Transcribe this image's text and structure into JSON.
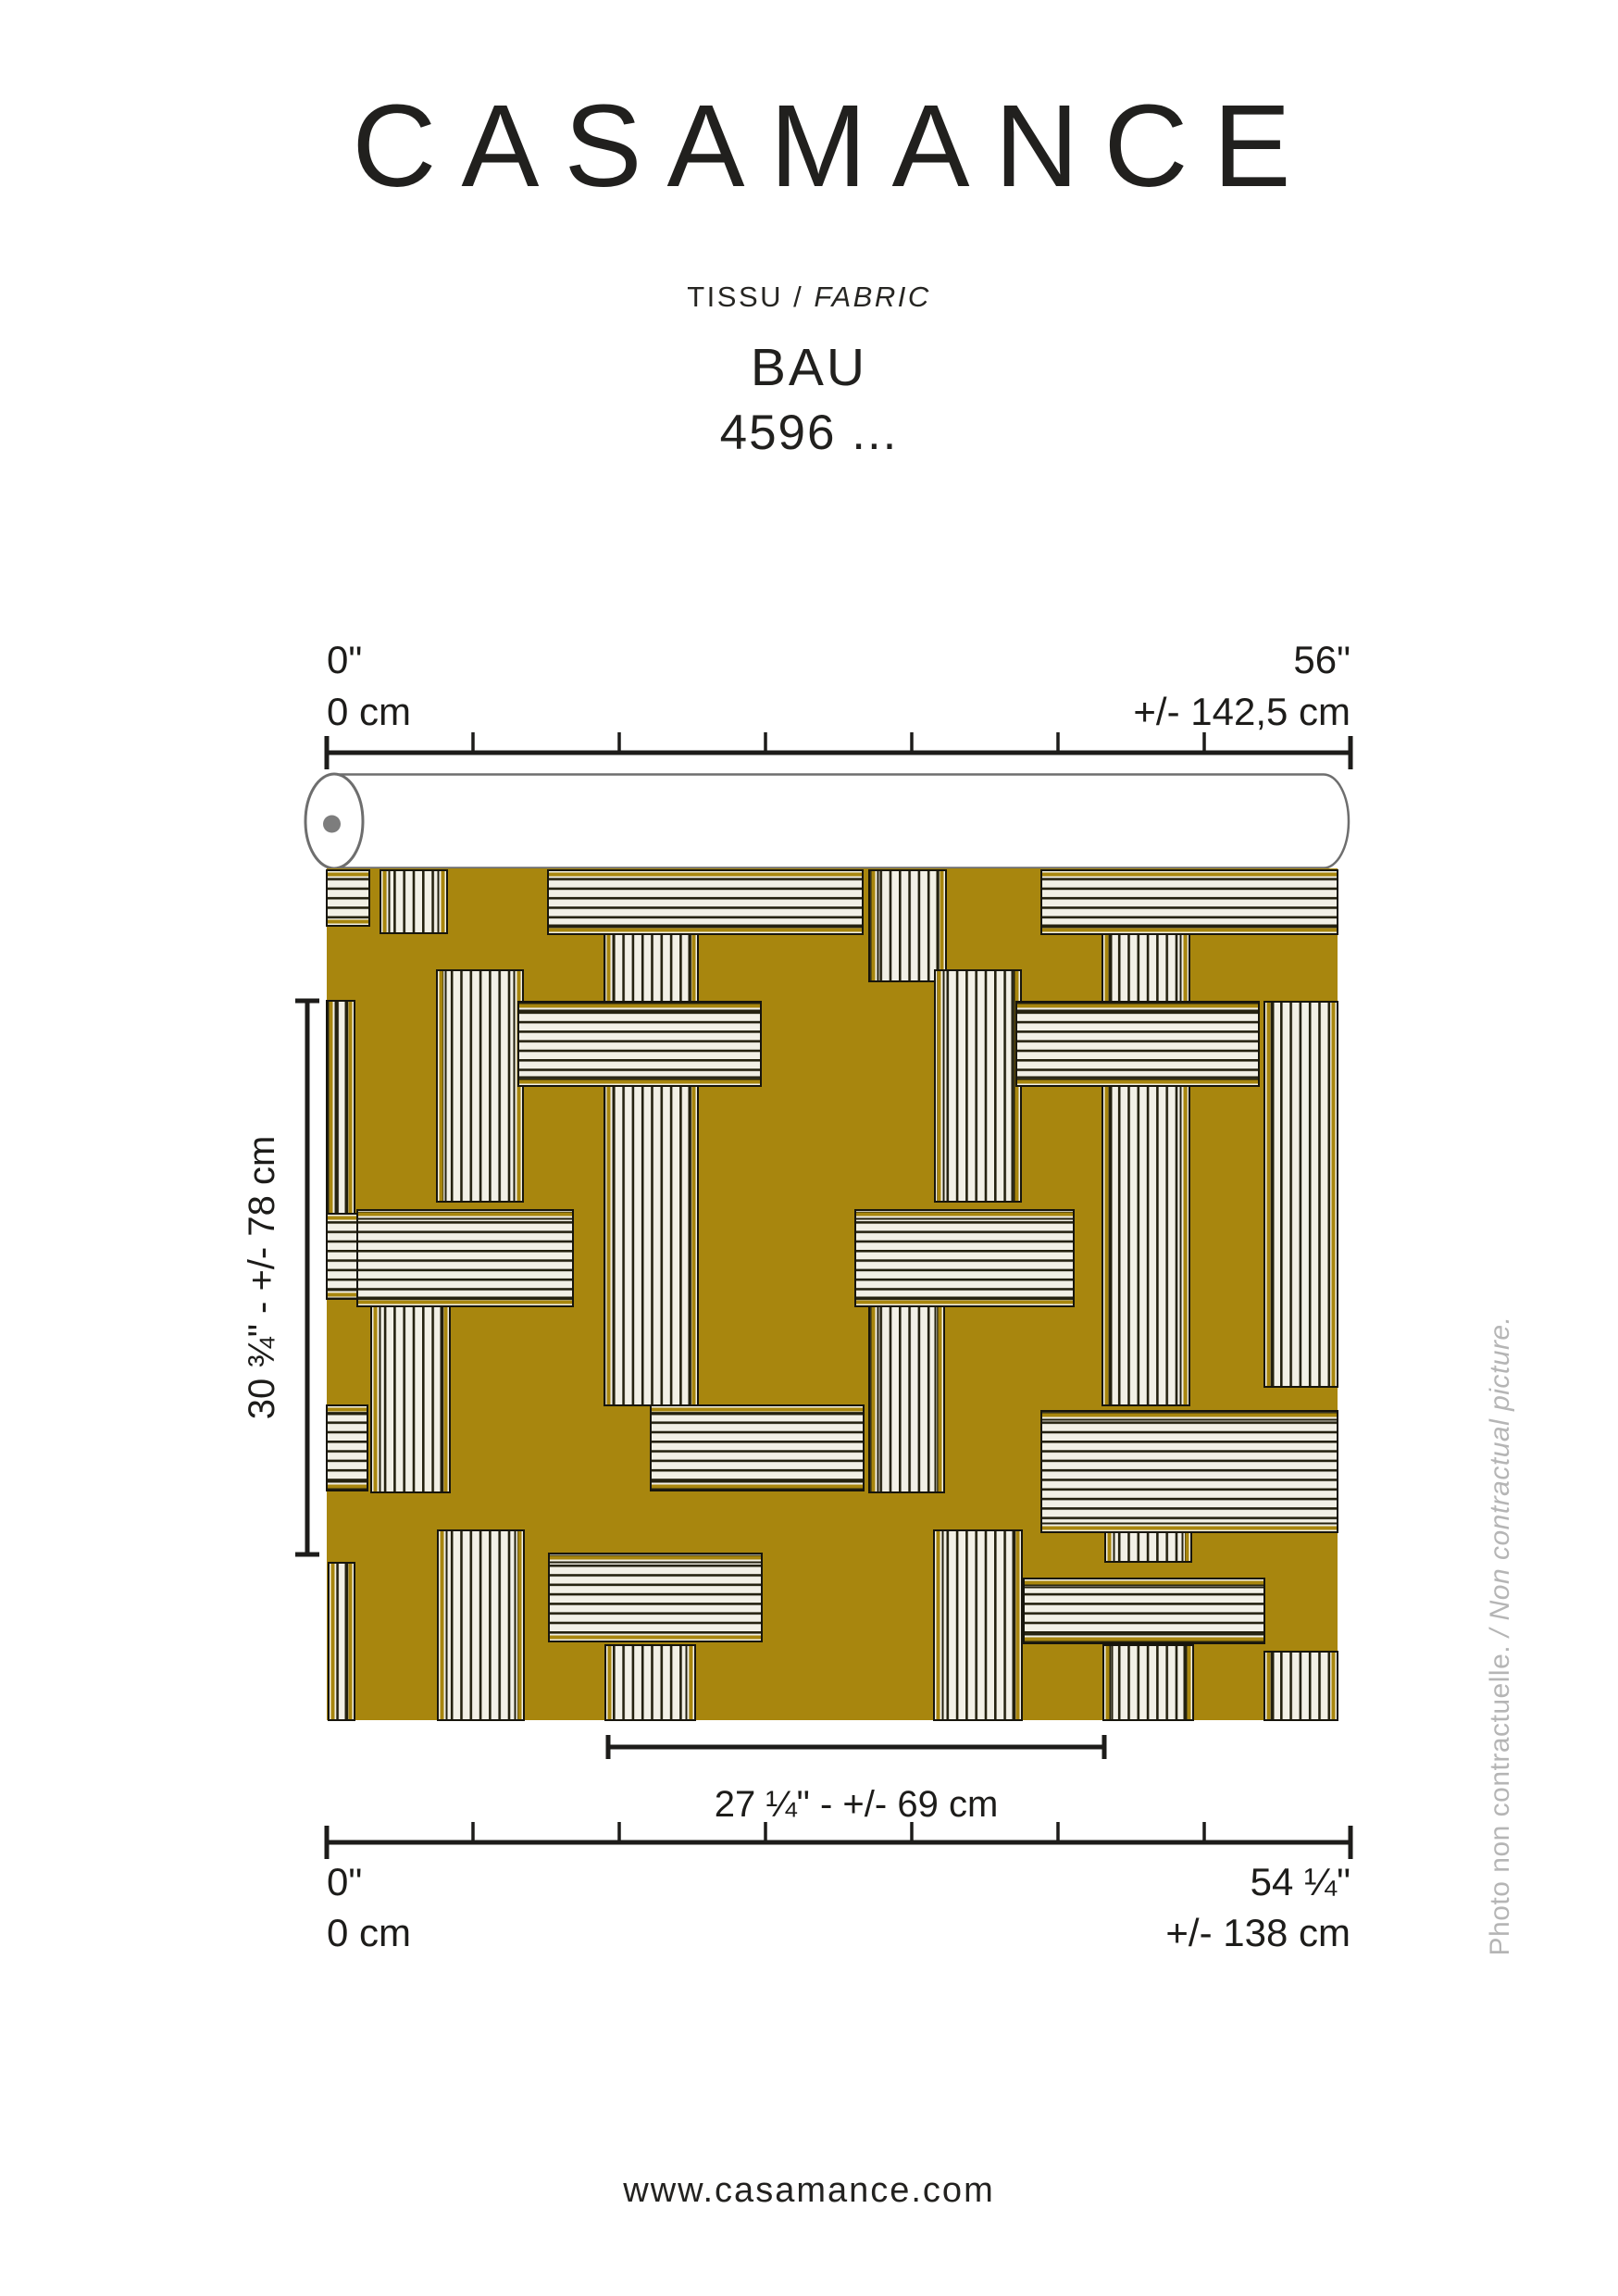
{
  "brand": {
    "logo": "CASAMANCE"
  },
  "header": {
    "category_fr": "TISSU / ",
    "category_en": "FABRIC",
    "product_name": "BAU",
    "reference": "4596 ..."
  },
  "diagram": {
    "roll_ruler": {
      "left_inches": "0\"",
      "left_cm": "0 cm",
      "right_inches": "56\"",
      "right_cm": "+/- 142,5 cm"
    },
    "fabric_ruler": {
      "left_inches": "0\"",
      "left_cm": "0 cm",
      "right_inches": "54 ¼\"",
      "right_cm": "+/- 138 cm"
    },
    "vertical_repeat": "30 ¾\" - +/- 78 cm",
    "horizontal_repeat": "27 ¼\" - +/- 69 cm"
  },
  "fabric": {
    "colors": {
      "ground": "#a8860e",
      "cream": "#f2f0e6",
      "stripe_line": "#24210f",
      "block_border": "#17150c"
    },
    "blocks": [
      [
        58,
        2,
        72,
        68,
        "v"
      ],
      [
        586,
        2,
        83,
        120,
        "v"
      ],
      [
        300,
        64,
        101,
        516,
        "v"
      ],
      [
        838,
        64,
        94,
        516,
        "v"
      ],
      [
        119,
        110,
        93,
        250,
        "v"
      ],
      [
        657,
        110,
        93,
        250,
        "v"
      ],
      [
        0,
        143,
        30,
        230,
        "v"
      ],
      [
        1013,
        144,
        79,
        416,
        "v"
      ],
      [
        48,
        473,
        85,
        201,
        "v"
      ],
      [
        586,
        473,
        81,
        201,
        "v"
      ],
      [
        841,
        675,
        93,
        74,
        "v"
      ],
      [
        120,
        715,
        93,
        205,
        "v"
      ],
      [
        656,
        715,
        95,
        205,
        "v"
      ],
      [
        301,
        839,
        97,
        81,
        "v"
      ],
      [
        839,
        839,
        97,
        81,
        "v"
      ],
      [
        2,
        750,
        28,
        170,
        "v"
      ],
      [
        1013,
        846,
        79,
        74,
        "v"
      ],
      [
        0,
        2,
        46,
        60,
        "h"
      ],
      [
        239,
        2,
        340,
        69,
        "h"
      ],
      [
        772,
        2,
        320,
        69,
        "h"
      ],
      [
        207,
        144,
        262,
        91,
        "h"
      ],
      [
        745,
        144,
        262,
        91,
        "h"
      ],
      [
        0,
        373,
        58,
        92,
        "h"
      ],
      [
        33,
        369,
        233,
        104,
        "h"
      ],
      [
        571,
        369,
        236,
        104,
        "h"
      ],
      [
        0,
        580,
        44,
        92,
        "h"
      ],
      [
        350,
        580,
        230,
        92,
        "h"
      ],
      [
        772,
        586,
        320,
        131,
        "h"
      ],
      [
        240,
        740,
        230,
        95,
        "h"
      ],
      [
        753,
        767,
        260,
        70,
        "h"
      ]
    ]
  },
  "side_note": {
    "fr": "Photo non contractuelle.",
    "sep": " / ",
    "en": "Non contractual picture."
  },
  "footer": {
    "website": "www.casamance.com"
  }
}
